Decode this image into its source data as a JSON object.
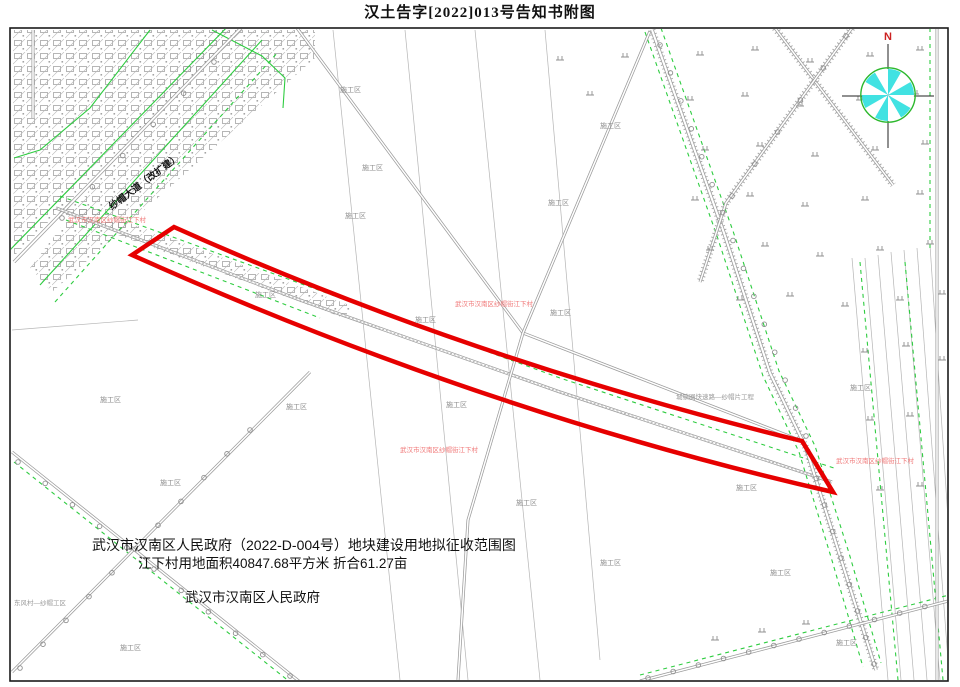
{
  "title": "汉土告字[2022]013号告知书附图",
  "map": {
    "notice": {
      "line1": "武汉市汉南区人民政府（2022-D-004号）地块建设用地拟征收范围图",
      "line2": "江下村用地面积40847.68平方米 折合61.27亩",
      "line3": "武汉市汉南区人民政府"
    },
    "compass": {
      "x": 888,
      "y": 95,
      "n_label": "N",
      "fill": "#41e2e2",
      "ring": "#2db82d",
      "n_color": "#cc2222"
    },
    "red_parcel": {
      "path": "M 174,227 Q 470,360 802,441 L 833,492 Q 482,412 132,255 Z",
      "color": "#e60000",
      "stroke_width": 4.5
    },
    "village_label": {
      "text": "武汉市汉南区纱帽街江下村",
      "color": "#f07878",
      "size": 6.5,
      "positions": [
        [
          68,
          222
        ],
        [
          455,
          306
        ],
        [
          400,
          452
        ],
        [
          836,
          463
        ]
      ]
    },
    "construction_label": {
      "text": "施工区",
      "color": "#8c8c8c",
      "size": 7,
      "positions": [
        [
          340,
          92
        ],
        [
          362,
          170
        ],
        [
          345,
          218
        ],
        [
          548,
          205
        ],
        [
          600,
          128
        ],
        [
          255,
          297
        ],
        [
          415,
          322
        ],
        [
          550,
          315
        ],
        [
          100,
          402
        ],
        [
          286,
          409
        ],
        [
          446,
          407
        ],
        [
          850,
          390
        ],
        [
          516,
          505
        ],
        [
          160,
          485
        ],
        [
          736,
          490
        ],
        [
          600,
          565
        ],
        [
          770,
          575
        ],
        [
          836,
          645
        ],
        [
          120,
          650
        ]
      ]
    },
    "single_labels": [
      {
        "text": "纱帽大道（改扩建）",
        "x": 112,
        "y": 210,
        "size": 9.5,
        "color": "#151515",
        "rotate": -37,
        "weight": "bold"
      },
      {
        "text": "城镇圈快速路—纱帽片工程",
        "x": 676,
        "y": 399,
        "size": 6.5,
        "color": "#9a9a9a",
        "rotate": 0,
        "weight": "normal"
      },
      {
        "text": "东风村—纱帽工区",
        "x": 14,
        "y": 605,
        "size": 6.5,
        "color": "#9a9a9a",
        "rotate": 0,
        "weight": "normal"
      }
    ],
    "colors": {
      "road": "#9b9b9b",
      "green": "#2ecc40",
      "field": "#b5b5b5",
      "grass": "#909090",
      "urban": "#999999"
    },
    "layers": {
      "urban_polys": [
        "12,30 242,30 14,256",
        "212,30 315,30 315,58 52,292 30,268",
        "58,196 352,306 344,318 50,210"
      ],
      "roads": [
        {
          "pts": [
            [
              14,
              262
            ],
            [
              243,
              26
            ]
          ],
          "w": 3.4
        },
        {
          "pts": [
            [
              56,
              208
            ],
            [
              300,
              300
            ],
            [
              560,
              392
            ],
            [
              832,
              482
            ]
          ],
          "w": 3.2,
          "mid": true
        },
        {
          "pts": [
            [
              297,
              28
            ],
            [
              523,
              333
            ],
            [
              802,
              441
            ]
          ],
          "w": 3
        },
        {
          "pts": [
            [
              650,
              31
            ],
            [
              523,
              333
            ],
            [
              468,
              520
            ],
            [
              458,
              680
            ]
          ],
          "w": 3
        },
        {
          "pts": [
            [
              652,
              30
            ],
            [
              724,
              233
            ],
            [
              770,
              373
            ],
            [
              806,
              448
            ],
            [
              840,
              556
            ],
            [
              876,
              670
            ]
          ],
          "w": 3.6,
          "tick": true
        },
        {
          "pts": [
            [
              775,
              28
            ],
            [
              893,
              185
            ]
          ],
          "w": 3,
          "tick": true
        },
        {
          "pts": [
            [
              852,
              28
            ],
            [
              726,
              203
            ],
            [
              700,
              282
            ]
          ],
          "w": 3,
          "tick": true
        },
        {
          "pts": [
            [
              937,
              28
            ],
            [
              937,
              680
            ]
          ],
          "w": 3
        },
        {
          "pts": [
            [
              12,
              672
            ],
            [
              310,
              372
            ]
          ],
          "w": 3
        },
        {
          "pts": [
            [
              12,
              452
            ],
            [
              300,
              682
            ]
          ],
          "w": 3
        },
        {
          "pts": [
            [
              640,
              681
            ],
            [
              956,
              599
            ]
          ],
          "w": 3
        },
        {
          "pts": [
            [
              33,
              30
            ],
            [
              33,
              118
            ]
          ],
          "w": 3
        }
      ],
      "greens": [
        {
          "pts": [
            [
              8,
              252
            ],
            [
              232,
              22
            ]
          ]
        },
        {
          "pts": [
            [
              40,
              285
            ],
            [
              262,
              40
            ]
          ]
        },
        {
          "pts": [
            [
              55,
              302
            ],
            [
              278,
              52
            ]
          ],
          "dash": true
        },
        {
          "pts": [
            [
              60,
              196
            ],
            [
              560,
              378
            ],
            [
              834,
              468
            ]
          ],
          "dash": true
        },
        {
          "pts": [
            [
              66,
              220
            ],
            [
              320,
              318
            ]
          ],
          "dash": true
        },
        {
          "pts": [
            [
              645,
              32
            ],
            [
              717,
              236
            ],
            [
              763,
              376
            ],
            [
              799,
              452
            ],
            [
              831,
              557
            ],
            [
              863,
              667
            ]
          ],
          "dash": true
        },
        {
          "pts": [
            [
              661,
              28
            ],
            [
              733,
              231
            ],
            [
              779,
              371
            ],
            [
              815,
              446
            ],
            [
              849,
              553
            ],
            [
              881,
              663
            ]
          ],
          "dash": true
        },
        {
          "pts": [
            [
              860,
              262
            ],
            [
              898,
              680
            ]
          ],
          "dash": true
        },
        {
          "pts": [
            [
              905,
              262
            ],
            [
              943,
              680
            ]
          ],
          "dash": true
        },
        {
          "pts": [
            [
              640,
              675
            ],
            [
              953,
              594
            ]
          ],
          "dash": true
        },
        {
          "pts": [
            [
              212,
              30
            ],
            [
              262,
              56
            ],
            [
              285,
              78
            ],
            [
              283,
              108
            ]
          ]
        },
        {
          "pts": [
            [
              150,
              30
            ],
            [
              90,
              108
            ],
            [
              40,
              150
            ],
            [
              14,
              158
            ]
          ]
        },
        {
          "pts": [
            [
              930,
              28
            ],
            [
              930,
              250
            ]
          ],
          "dash": true
        },
        {
          "pts": [
            [
              16,
              668
            ],
            [
              305,
              378
            ]
          ],
          "dash": true
        },
        {
          "pts": [
            [
              14,
              462
            ],
            [
              295,
              686
            ]
          ],
          "dash": true
        }
      ],
      "fields": [
        [
          [
            333,
            30
          ],
          [
            400,
            680
          ]
        ],
        [
          [
            405,
            30
          ],
          [
            468,
            680
          ]
        ],
        [
          [
            475,
            30
          ],
          [
            540,
            680
          ]
        ],
        [
          [
            545,
            30
          ],
          [
            600,
            660
          ]
        ],
        [
          [
            12,
            330
          ],
          [
            138,
            320
          ]
        ],
        [
          [
            852,
            258
          ],
          [
            888,
            680
          ]
        ],
        [
          [
            865,
            258
          ],
          [
            901,
            680
          ]
        ],
        [
          [
            878,
            255
          ],
          [
            914,
            680
          ]
        ],
        [
          [
            891,
            252
          ],
          [
            927,
            680
          ]
        ],
        [
          [
            904,
            250
          ],
          [
            940,
            680
          ]
        ],
        [
          [
            917,
            248
          ],
          [
            948,
            660
          ]
        ],
        [
          [
            930,
            245
          ],
          [
            952,
            580
          ]
        ]
      ],
      "grass": [
        [
          700,
          55
        ],
        [
          755,
          50
        ],
        [
          810,
          62
        ],
        [
          870,
          56
        ],
        [
          920,
          50
        ],
        [
          625,
          57
        ],
        [
          560,
          60
        ],
        [
          590,
          95
        ],
        [
          690,
          100
        ],
        [
          745,
          96
        ],
        [
          800,
          106
        ],
        [
          860,
          100
        ],
        [
          915,
          94
        ],
        [
          705,
          150
        ],
        [
          760,
          146
        ],
        [
          815,
          156
        ],
        [
          875,
          150
        ],
        [
          925,
          144
        ],
        [
          695,
          200
        ],
        [
          750,
          196
        ],
        [
          805,
          206
        ],
        [
          865,
          200
        ],
        [
          920,
          194
        ],
        [
          710,
          250
        ],
        [
          765,
          246
        ],
        [
          820,
          256
        ],
        [
          880,
          250
        ],
        [
          930,
          244
        ],
        [
          740,
          300
        ],
        [
          790,
          296
        ],
        [
          845,
          306
        ],
        [
          900,
          300
        ],
        [
          942,
          294
        ],
        [
          865,
          352
        ],
        [
          906,
          346
        ],
        [
          942,
          360
        ],
        [
          870,
          420
        ],
        [
          910,
          416
        ],
        [
          880,
          490
        ],
        [
          920,
          486
        ],
        [
          715,
          640
        ],
        [
          762,
          632
        ],
        [
          806,
          624
        ]
      ],
      "tree_rows": [
        {
          "a": [
            660,
            45
          ],
          "b": [
            806,
            436
          ],
          "n": 15
        },
        {
          "a": [
            808,
            452
          ],
          "b": [
            874,
            664
          ],
          "n": 9
        },
        {
          "a": [
            20,
            668
          ],
          "b": [
            250,
            430
          ],
          "n": 11
        },
        {
          "a": [
            18,
            462
          ],
          "b": [
            290,
            676
          ],
          "n": 11
        },
        {
          "a": [
            648,
            678
          ],
          "b": [
            950,
            600
          ],
          "n": 13
        },
        {
          "a": [
            62,
            218
          ],
          "b": [
            214,
            62
          ],
          "n": 6
        },
        {
          "a": [
            846,
            36
          ],
          "b": [
            732,
            196
          ],
          "n": 6
        }
      ]
    }
  }
}
